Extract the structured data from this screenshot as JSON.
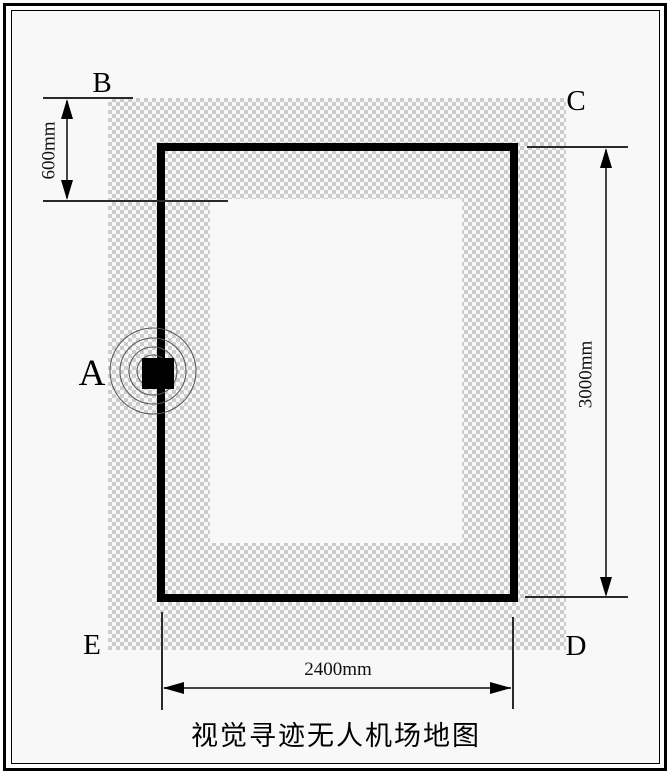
{
  "diagram": {
    "title": "视觉寻迹无人机场地图",
    "points": {
      "a": "A",
      "b": "B",
      "c": "C",
      "d": "D",
      "e": "E"
    },
    "dimensions": {
      "zone_offset": "600mm",
      "field_height": "3000mm",
      "field_width": "2400mm"
    },
    "colors": {
      "track_line": "#000000",
      "zone_checker": "#cccccc",
      "paper_background": "#f8f8f8",
      "dimension_line": "#444444"
    }
  }
}
